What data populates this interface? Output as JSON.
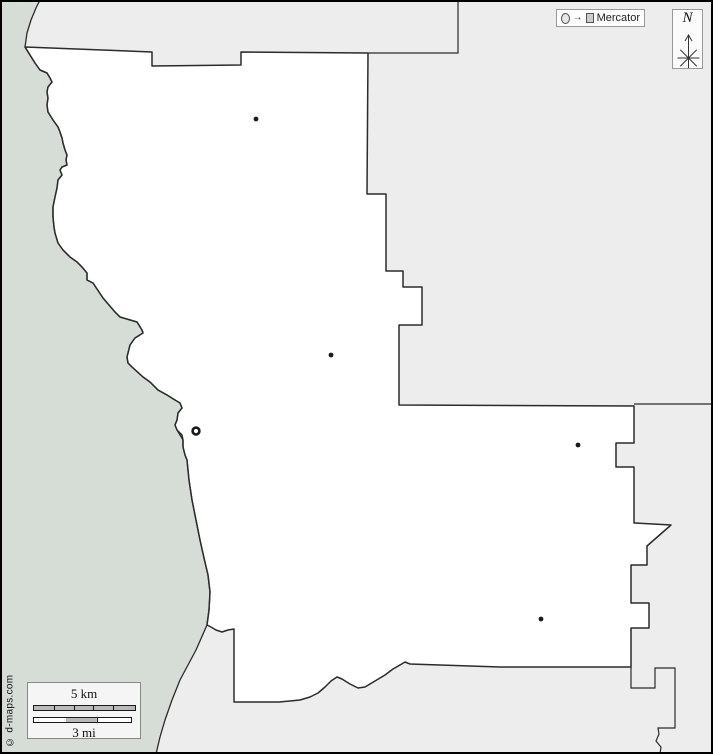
{
  "projection_box": {
    "label": "Mercator"
  },
  "compass": {
    "label": "N"
  },
  "scale": {
    "km_label": "5 km",
    "mi_label": "3 mi",
    "km_segments": 5,
    "mi_segments": 3
  },
  "copyright": "© d-maps.com",
  "colors": {
    "water": "#d6dcd6",
    "outside_land": "#ededed",
    "county_fill": "#ffffff",
    "border": "#2b2b2b",
    "frame": "#000000",
    "city": "#1a1a1a"
  },
  "map": {
    "width": 713,
    "height": 754,
    "land_path": "M40,0 L36,8 L31,20 L27,33 L25,47 L30,55 L35,63 L40,70 L47,73 L50,78 L52,82 L48,87 L47,92 L48,98 L47,105 L48,112 L53,120 L58,127 L60,132 L62,138 L63,143 L65,150 L67,155 L66,160 L67,165 L62,167 L60,170 L62,175 L58,180 L57,188 L55,197 L53,207 L53,217 L54,227 L55,233 L58,243 L63,250 L70,257 L77,262 L82,267 L87,273 L87,280 L93,283 L103,298 L115,312 L120,317 L137,322 L142,330 L143,333 L135,338 L130,345 L127,357 L128,363 L132,367 L143,377 L150,382 L158,390 L167,395 L175,400 L180,403 L182,408 L178,413 L177,420 L175,425 L177,430 L183,440 L183,447 L185,455 L187,460 L189,480 L192,500 L196,520 L200,540 L204,558 L208,575 L210,592 L209,610 L207,625 L196,650 L188,665 L180,680 L172,700 L165,720 L160,737 L156,754 L713,754 L713,0 Z",
    "coastline_path": "M40,0 L36,8 L31,20 L27,33 L25,47 L30,55 L35,63 L40,70 L47,73 L50,78 L52,82 L48,87 L47,92 L48,98 L47,105 L48,112 L53,120 L58,127 L60,132 L62,138 L63,143 L65,150 L67,155 L66,160 L67,165 L62,167 L60,170 L62,175 L58,180 L57,188 L55,197 L53,207 L53,217 L54,227 L55,233 L58,243 L63,250 L70,257 L77,262 L82,267 L87,273 L87,280 L93,283 L103,298 L115,312 L120,317 L137,322 L142,330 L143,333 L135,338 L130,345 L127,357 L128,363 L132,367 L143,377 L150,382 L158,390 L167,395 L175,400 L180,403 L182,408 L178,413 L177,420 L175,425 L177,430 L183,440 L183,447 L185,455 L187,460 L189,480 L192,500 L196,520 L200,540 L204,558 L208,575 L210,592 L209,610 L207,625 L196,650 L188,665 L180,680 L172,700 L165,720 L160,737 L156,754",
    "county_path": "M25,47 L152,52 L152,66 L241,65 L241,52 L368,53 L367,194 L386,194 L386,271 L403,271 L403,287 L422,287 L422,325 L399,325 L399,405 L634,406 L634,443 L616,443 L616,467 L634,467 L634,523 L671,525 L647,546 L647,565 L631,565 L631,603 L649,603 L649,628 L631,628 L631,667 L500,667 L410,664 L405,662 L400,665 L393,669 L385,675 L375,681 L365,687 L358,688 L350,684 L342,679 L337,677 L331,681 L325,687 L318,693 L310,697 L300,700 L290,701 L279,702 L234,702 L234,629 L228,630 L222,632 L216,630 L211,627 L207,625 L209,610 L210,592 L208,575 L204,558 L200,540 L196,520 L192,500 L189,480 L187,460 L185,455 L183,447 L183,440 L182,435 L177,430 L175,425 L177,420 L178,413 L182,408 L180,403 L175,400 L167,395 L158,390 L150,382 L143,377 L132,367 L128,363 L127,357 L130,345 L135,338 L143,333 L142,330 L137,322 L120,317 L115,312 L103,298 L93,283 L87,280 L87,273 L82,267 L77,262 L70,257 L63,250 L58,243 L55,233 L54,227 L53,217 L53,207 L55,197 L57,188 L58,180 L62,175 L60,170 L62,167 L67,165 L66,160 L67,155 L65,150 L63,143 L62,138 L60,132 L58,127 L53,120 L48,112 L47,105 L48,98 L47,92 L48,87 L52,82 L50,78 L47,73 L40,70 L35,63 L30,55 Z",
    "divider_paths": [
      "M368,53 L458,53 L458,0",
      "M634,404 L713,404",
      "M631,667 L631,688 L655,688 L655,668 L675,668 L675,728 L658,728 L659,734 L656,741 L661,747 L660,754"
    ],
    "cities": [
      {
        "x": 256,
        "y": 119
      },
      {
        "x": 331,
        "y": 355
      },
      {
        "x": 578,
        "y": 445
      },
      {
        "x": 541,
        "y": 619
      }
    ],
    "county_seat": {
      "x": 196,
      "y": 431
    }
  },
  "compass_glyph": {
    "center_x": 15.5,
    "center_y": 44,
    "arrow_top_y": 21,
    "arrow_bottom_y": 57,
    "arm": 11
  }
}
